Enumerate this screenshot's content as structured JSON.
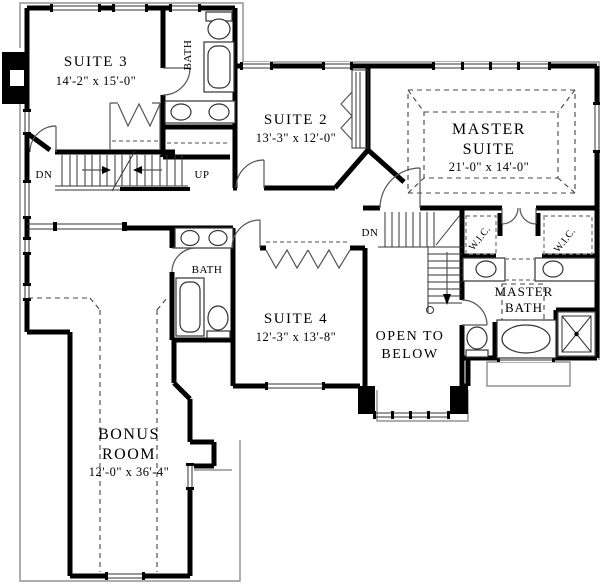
{
  "plan": {
    "title": "Second floor plan",
    "rooms": {
      "suite3": {
        "name": "SUITE 3",
        "dims": "14'-2\" x 15'-0\""
      },
      "suite2": {
        "name": "SUITE 2",
        "dims": "13'-3\" x 12'-0\""
      },
      "master_suite": {
        "name_line1": "MASTER",
        "name_line2": "SUITE",
        "dims": "21'-0\" x 14'-0\""
      },
      "suite4": {
        "name": "SUITE 4",
        "dims": "12'-3\" x 13'-8\""
      },
      "bonus_room": {
        "name_line1": "BONUS",
        "name_line2": "ROOM",
        "dims": "12'-0\" x 36'-4\""
      },
      "open_to_below": {
        "line1": "OPEN TO",
        "line2": "BELOW"
      },
      "master_bath": {
        "line1": "MASTER",
        "line2": "BATH"
      },
      "bath_upper": {
        "name": "BATH"
      },
      "bath_mid": {
        "name": "BATH"
      },
      "wic_left": {
        "name": "W.I.C."
      },
      "wic_right": {
        "name": "W.I.C."
      }
    },
    "stairs": {
      "down_main": "DN",
      "up_main": "UP",
      "down_right": "DN"
    },
    "colors": {
      "wall": "#000000",
      "thin_line": "#333333",
      "roof_outline": "#949494",
      "background": "#ffffff"
    }
  }
}
